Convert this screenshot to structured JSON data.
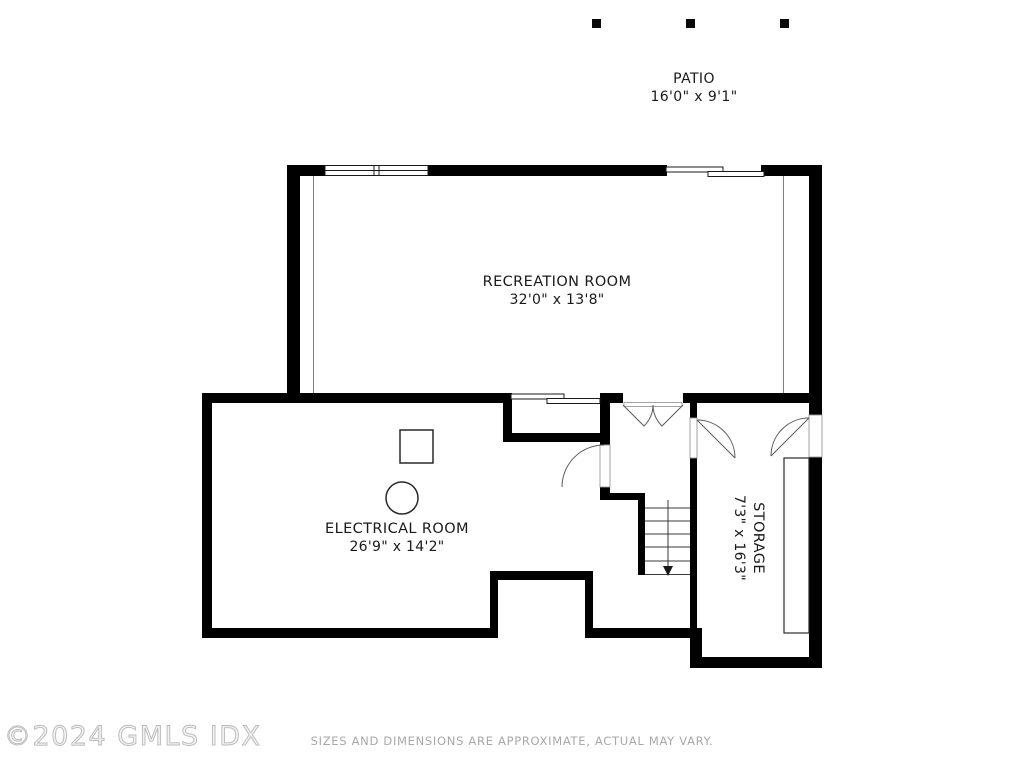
{
  "plan": {
    "type": "basement-floor-plan",
    "rooms": {
      "patio": {
        "name": "PATIO",
        "dims": "16'0\" x 9'1\""
      },
      "recreation": {
        "name": "RECREATION ROOM",
        "dims": "32'0\" x 13'8\""
      },
      "electrical": {
        "name": "ELECTRICAL ROOM",
        "dims": "26'9\" x 14'2\""
      },
      "storage": {
        "name": "STORAGE",
        "dims": "7'3\" x 16'3\""
      }
    },
    "features": [
      "double-window",
      "sliding-door",
      "french-doors",
      "staircase-down",
      "storage-shelf",
      "patio-posts"
    ]
  },
  "footer": {
    "copyright": "©2024 GMLS IDX",
    "disclaimer": "SIZES AND DIMENSIONS ARE APPROXIMATE, ACTUAL MAY VARY."
  },
  "colors": {
    "wall": "#000000",
    "background": "#ffffff",
    "label_text": "#1a1a1a",
    "watermark": "#c9c9c9",
    "disclaimer_text": "#a8a8a8"
  }
}
